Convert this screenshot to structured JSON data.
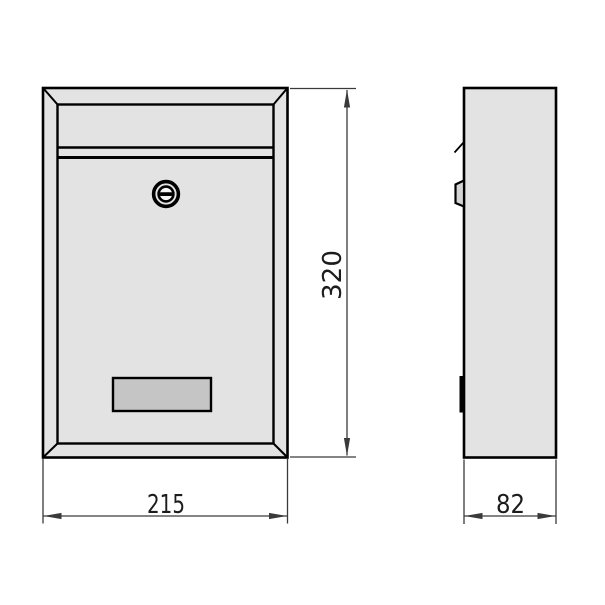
{
  "drawing": {
    "labels": {
      "width": "215",
      "height": "320",
      "depth": "82"
    },
    "icons": {
      "lock": "round-cam-lock-with-horizontal-keyslot",
      "side_lock": "lock-cylinder-protrusion",
      "hinge_mark": "flap-hinge-tick"
    },
    "colors": {
      "background": "#ffffff",
      "body_fill": "#e3e3e3",
      "plate_fill": "#c5c5c5",
      "side_lock_fill": "#d4d4d4",
      "lock_center_fill": "#f7f7f7",
      "outline": "#000000",
      "dimension": "#3a3a3a",
      "text": "#1c1c1c"
    }
  }
}
